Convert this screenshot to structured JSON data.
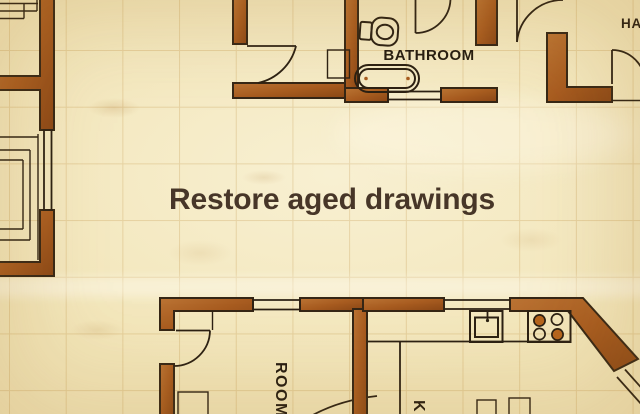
{
  "headline": {
    "text": "Restore aged drawings"
  },
  "plan": {
    "labels": {
      "bathroom": "BATHROOM",
      "hall": "HA",
      "room": "ROOM",
      "kitchen": "K"
    },
    "colors": {
      "paper": "#f2e5b8",
      "paper_light": "#f8f0d2",
      "grid": "#b88432",
      "wall": "#a85c20",
      "wall_light": "#bb7434",
      "wall_dark": "#8a4716",
      "outline": "#352615",
      "ink": "#2b2013",
      "burner": "#b5651d",
      "headline_color": "#473628",
      "label_color": "#241b10"
    }
  }
}
